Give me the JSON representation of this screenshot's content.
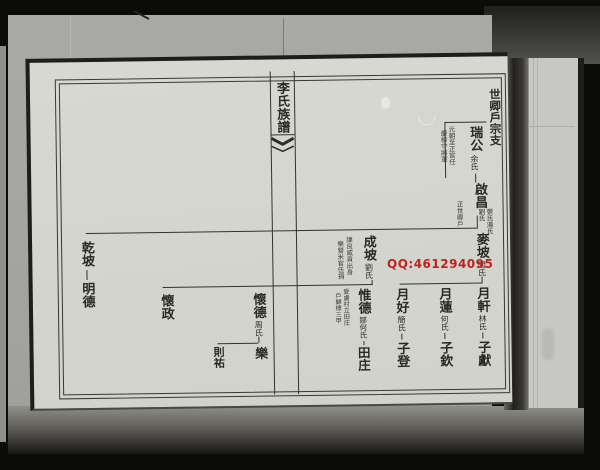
{
  "watermark": {
    "text": "QQ:461294095",
    "color": "#c32020"
  },
  "page": {
    "banner_title": "李氏族譜",
    "section_header": "世卿戶宗支",
    "tree": {
      "gen1": {
        "name": "瑞公",
        "spouse": "余氏",
        "note_col1": "元朝至正官任",
        "note_col2": "慶柳守將軍"
      },
      "gen2": {
        "name": "啟昌",
        "spouse_col1": "張氏湯氏",
        "spouse_col2": "劉氏",
        "note": "正世卿戶"
      },
      "gen3": [
        {
          "name": "麥坡",
          "spouse": "閻氏"
        },
        {
          "name": "成坡",
          "spouse": "劉氏",
          "note_col1": "諱良威貢出身",
          "note_col2": "樂營米官伍捐"
        },
        {
          "name": "乾坡",
          "child": "明德"
        }
      ],
      "gen4_maipo_line": [
        {
          "name": "月軒",
          "spouse": "林氏",
          "child": "子獻"
        },
        {
          "name": "月蓮",
          "spouse": "何氏",
          "child": "子欽"
        },
        {
          "name": "月好",
          "spouse": "簡氏",
          "child": "子登"
        }
      ],
      "gen4_chengpo_line": [
        {
          "name": "惟德",
          "spouse": "鄒何氏",
          "note_col1": "愛盧村立田庄",
          "note_col2": "戶歸棣三甲",
          "child": "田庄"
        },
        {
          "name": "懷德",
          "spouse": "周氏",
          "child_right": "樂",
          "child_left": "則祐"
        },
        {
          "name": "懷政"
        }
      ]
    }
  }
}
